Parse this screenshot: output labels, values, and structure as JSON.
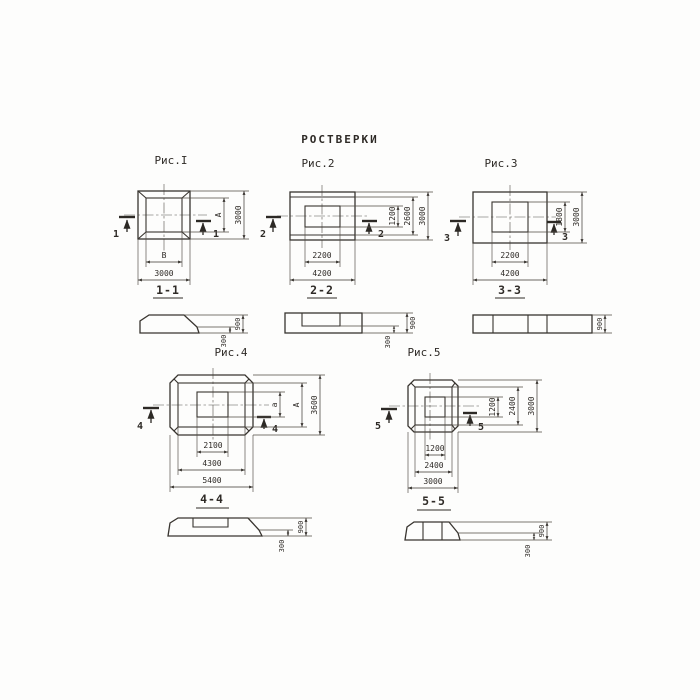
{
  "title": "РОСТВЕРКИ",
  "colors": {
    "paper": "#fdfdfc",
    "ink": "#38342f"
  },
  "figures": {
    "fig1": {
      "caption": "Рис.I",
      "cut_label": "1",
      "dims": {
        "inner_height": "А",
        "outer_height": "3000",
        "inner_width": "В",
        "outer_width": "3000"
      },
      "section_title": "1-1",
      "section_dims": {
        "ledge": "300",
        "total": "900"
      }
    },
    "fig2": {
      "caption": "Рис.2",
      "cut_label": "2",
      "dims": {
        "v1": "1200",
        "v2": "2600",
        "v3": "3000",
        "b1": "2200",
        "b2": "4200"
      },
      "section_title": "2-2",
      "section_dims": {
        "ledge": "300",
        "total": "900"
      }
    },
    "fig3": {
      "caption": "Рис.3",
      "cut_label": "3",
      "dims": {
        "v1": "1800",
        "v2": "3000",
        "b1": "2200",
        "b2": "4200"
      },
      "section_title": "3-3",
      "section_dims": {
        "total": "900"
      }
    },
    "fig4": {
      "caption": "Рис.4",
      "cut_label": "4",
      "dims": {
        "v1": "а",
        "v2": "А",
        "v3": "3600",
        "b1": "2100",
        "b2": "4300",
        "b3": "5400"
      },
      "section_title": "4-4",
      "section_dims": {
        "ledge": "300",
        "total": "900"
      }
    },
    "fig5": {
      "caption": "Рис.5",
      "cut_label": "5",
      "dims": {
        "v1": "1200",
        "v2": "2400",
        "v3": "3000",
        "b1": "1200",
        "b2": "2400",
        "b3": "3000"
      },
      "section_title": "5-5",
      "section_dims": {
        "ledge": "300",
        "total": "900"
      }
    }
  }
}
